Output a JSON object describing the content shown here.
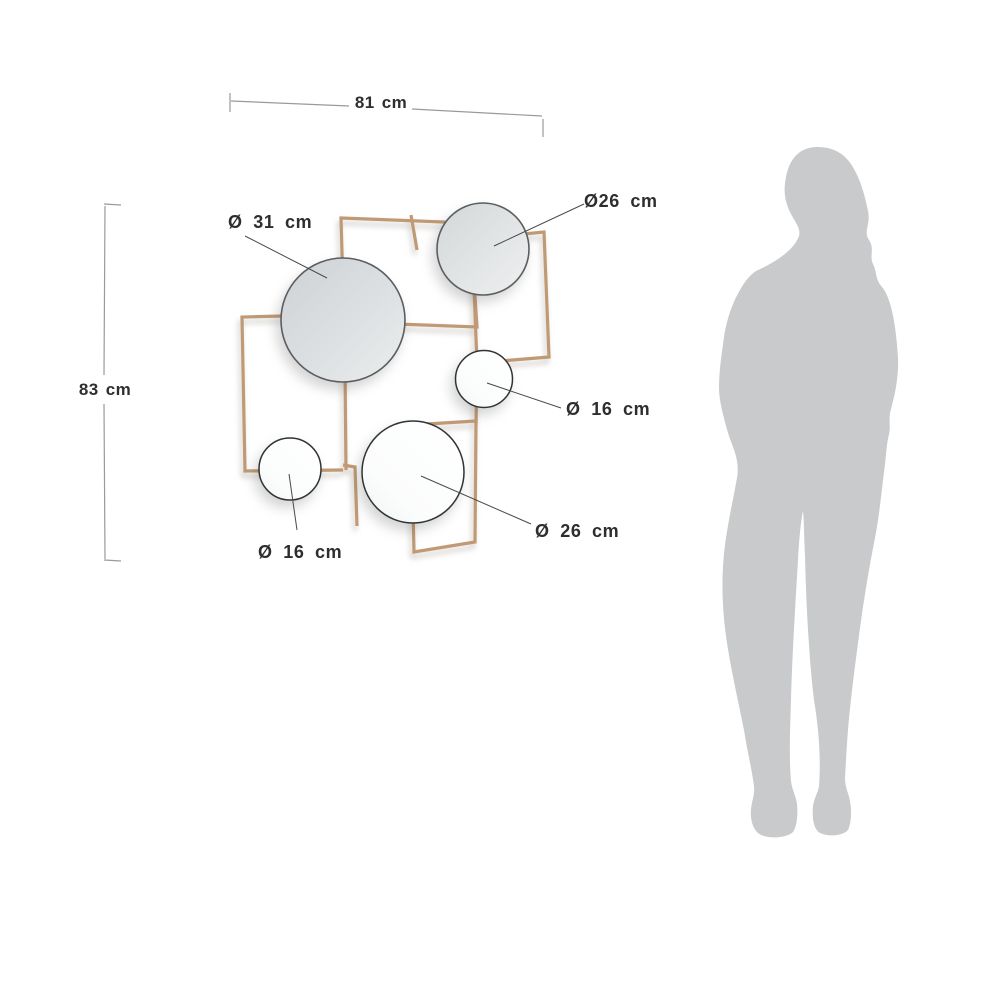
{
  "figure": {
    "type": "product-dimension-diagram",
    "overall": {
      "width": "81 cm",
      "height": "83 cm"
    },
    "labels": {
      "mirror_large": "Ø 31 cm",
      "mirror_top_right": "Ø26 cm",
      "mirror_mid_right": "Ø 16 cm",
      "mirror_bottom_center": "Ø 26 cm",
      "mirror_bottom_left": "Ø 16 cm"
    },
    "colors": {
      "background": "#ffffff",
      "frame_color": "#c09a74",
      "dim_line_color": "#9a9a9a",
      "leader_line_color": "#4a4a4a",
      "text_color": "#2e2e2e",
      "silhouette_color": "#c9cacb",
      "mirror_gray": "#d2d5d7",
      "mirror_white": "#fdfdfd"
    }
  }
}
